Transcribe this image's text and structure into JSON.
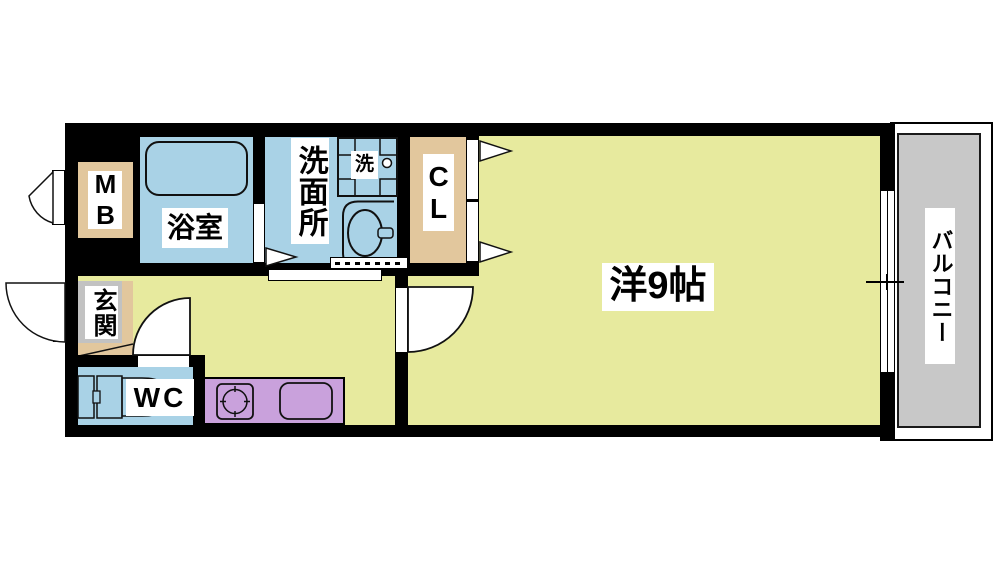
{
  "title": "1K floor plan",
  "labels": {
    "meter_box": "MB",
    "bathroom": "浴室",
    "washroom": "洗面所",
    "laundry": "洗",
    "closet": "CL",
    "main_room": "洋9帖",
    "balcony": "バルコニー",
    "entrance": "玄関",
    "wc": "WC"
  },
  "colors": {
    "wall": "#000000",
    "floor_yellow": "#e7ea9e",
    "wet_blue": "#a9d2e6",
    "tan": "#e2c79d",
    "purple": "#c9a1dc",
    "balcony_gray": "#c8c8c8",
    "entrance_gray": "#c2c2c2",
    "line": "#111111"
  }
}
